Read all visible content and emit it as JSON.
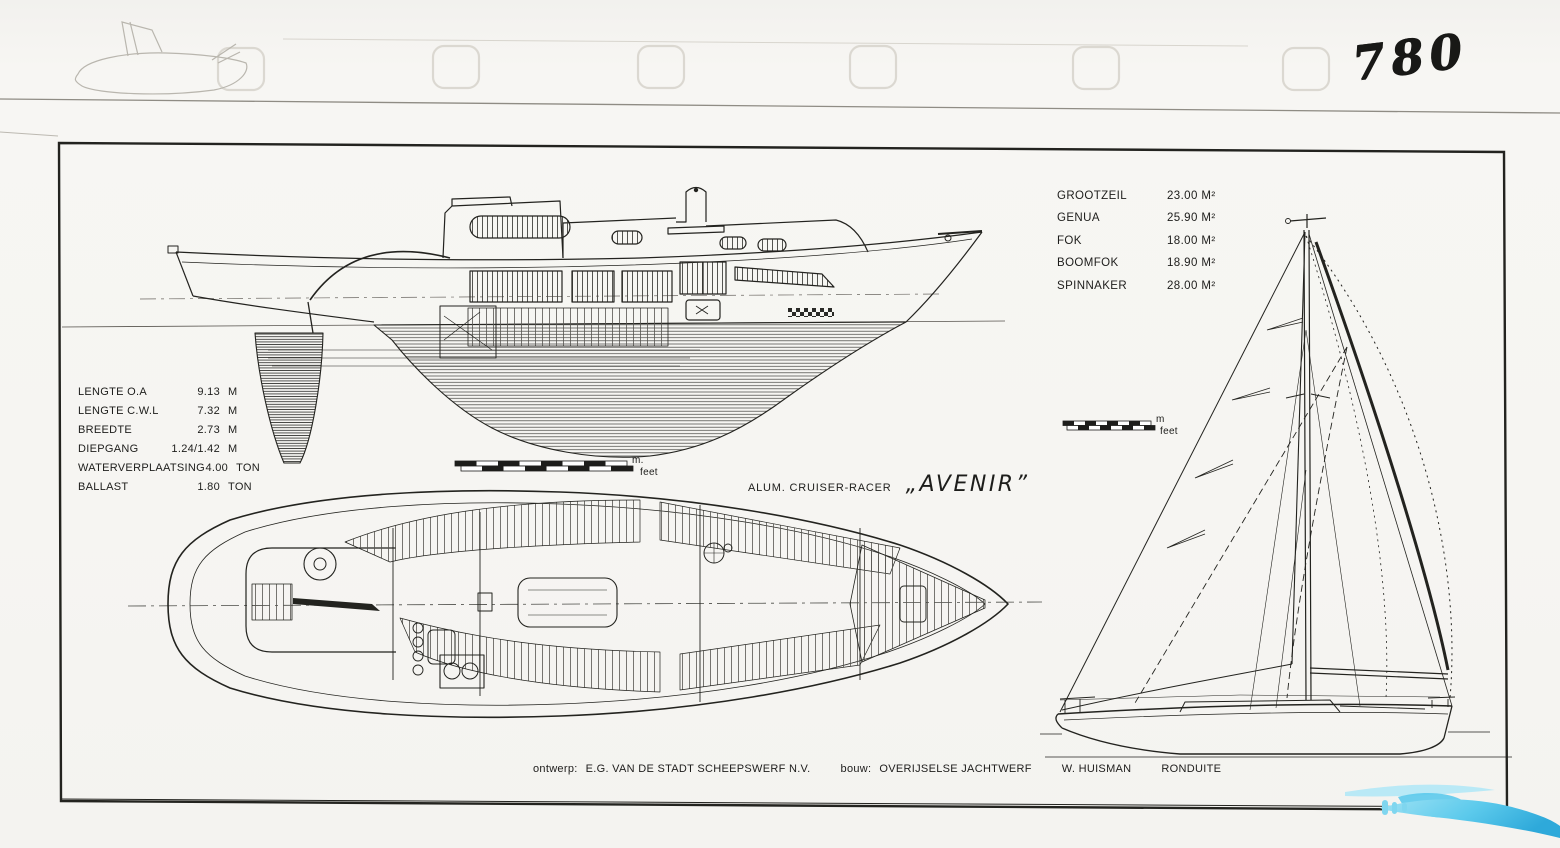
{
  "colors": {
    "ink": "#1d1d1b",
    "paper": "#f6f5f2",
    "faint_scan_gray": "#d8d5ce",
    "watermark_blue": "#5ccaec"
  },
  "annotations": {
    "sheet_number": "780"
  },
  "title": {
    "type_label": "ALUM. CRUISER-RACER",
    "boat_name": "„AVENIR”"
  },
  "dimensions": {
    "rows": [
      {
        "label": "LENGTE O.A",
        "value": "9.13",
        "unit": "M"
      },
      {
        "label": "LENGTE C.W.L",
        "value": "7.32",
        "unit": "M"
      },
      {
        "label": "BREEDTE",
        "value": "2.73",
        "unit": "M"
      },
      {
        "label": "DIEPGANG",
        "value": "1.24/1.42",
        "unit": "M"
      },
      {
        "label": "WATERVERPLAATSING",
        "value": "4.00",
        "unit": "TON"
      },
      {
        "label": "BALLAST",
        "value": "1.80",
        "unit": "TON"
      }
    ]
  },
  "sail_areas": {
    "rows": [
      {
        "label": "GROOTZEIL",
        "value": "23.00 M²"
      },
      {
        "label": "GENUA",
        "value": "25.90 M²"
      },
      {
        "label": "FOK",
        "value": "18.00 M²"
      },
      {
        "label": "BOOMFOK",
        "value": "18.90 M²"
      },
      {
        "label": "SPINNAKER",
        "value": "28.00 M²"
      }
    ]
  },
  "scale_bars": {
    "profile": {
      "metric": "m.",
      "imperial": "feet"
    },
    "sail": {
      "metric": "m",
      "imperial": "feet"
    }
  },
  "credits": {
    "design_label": "ontwerp:",
    "designer": "E.G. VAN DE STADT  SCHEEPSWERF  N.V.",
    "build_label": "bouw:",
    "builder_yard": "OVERIJSELSE JACHTWERF",
    "builder_name": "W. HUISMAN",
    "builder_location": "RONDUITE"
  }
}
